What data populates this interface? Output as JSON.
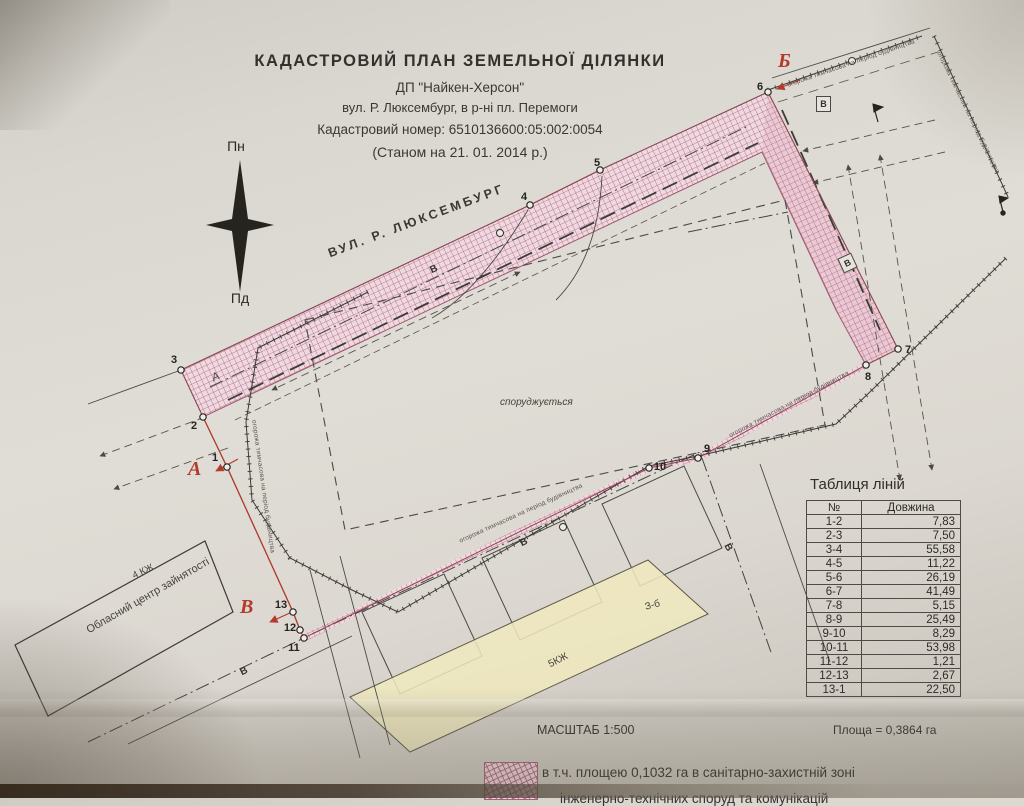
{
  "document": {
    "title": "КАДАСТРОВИЙ  ПЛАН  ЗЕМЕЛЬНОЇ  ДІЛЯНКИ",
    "company": "ДП \"Найкен-Херсон\"",
    "location": "вул. Р. Люксембург, в р-ні пл. Перемоги",
    "cadastral_number_line": "Кадастровий номер: 6510136600:05:002:0054",
    "as_of_date_line": "(Станом на 21. 01. 2014 р.)"
  },
  "compass": {
    "north_label": "Пн",
    "south_label": "Пд"
  },
  "map": {
    "street_label": "ВУЛ.  Р.  ЛЮКСЕМБУРГ",
    "under_construction_label": "споруджується",
    "employment_center_label": "Обласний центр зайнятості",
    "building_4kzh_label": "4 КЖ",
    "building_5kzh_label": "5КЖ",
    "building_zb_label": "З-б",
    "temp_fence_label": "огорожа тимчасова на період будівництва",
    "water_line_mark": "В",
    "line_a_mark": "А",
    "point_labels": [
      "1",
      "2",
      "3",
      "4",
      "5",
      "6",
      "7",
      "8",
      "9",
      "10",
      "11",
      "12",
      "13"
    ],
    "section_marks": {
      "a": "А",
      "b": "Б",
      "v": "В"
    }
  },
  "lines_table": {
    "title": "Таблиця ліній",
    "columns": [
      "№",
      "Довжина"
    ],
    "rows": [
      [
        "1-2",
        "7,83"
      ],
      [
        "2-3",
        "7,50"
      ],
      [
        "3-4",
        "55,58"
      ],
      [
        "4-5",
        "11,22"
      ],
      [
        "5-6",
        "26,19"
      ],
      [
        "6-7",
        "41,49"
      ],
      [
        "7-8",
        "5,15"
      ],
      [
        "8-9",
        "25,49"
      ],
      [
        "9-10",
        "8,29"
      ],
      [
        "10-11",
        "53,98"
      ],
      [
        "11-12",
        "1,21"
      ],
      [
        "12-13",
        "2,67"
      ],
      [
        "13-1",
        "22,50"
      ]
    ]
  },
  "footer": {
    "scale_label": "МАСШТАБ 1:500",
    "area_label": "Площа = 0,3864 га",
    "legend_text_line1": "в т.ч. площею 0,1032 га в санітарно-захистній зоні",
    "legend_text_line2": "інженерно-технічних споруд та комунікацій"
  },
  "colors": {
    "hatch_line": "#ad5f7c",
    "hatch_fill": "#efd9e0",
    "red_mark": "#b23b2e",
    "paper": "#dcd9d2"
  }
}
